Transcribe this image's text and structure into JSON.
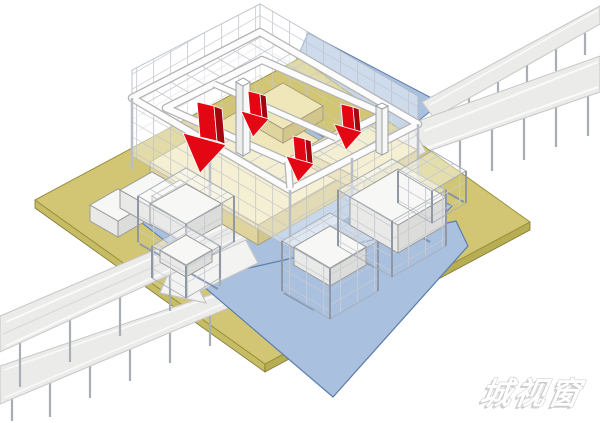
{
  "watermark": {
    "text": "城视窗"
  },
  "annotations": {
    "red_down_arrow_count": 4,
    "flow_arrow_direction": "southwest"
  },
  "colors": {
    "site_plate": "#d2c675",
    "site_plate_side": "#c6bc63",
    "canal_blue": "#a9c0de",
    "canal_blue_edge": "#5d7dab",
    "podium": "#efe6ba",
    "podium_side": "#e0d49e",
    "podium_side_dark": "#d2c68c",
    "road_fill": "#ebebea",
    "road_edge": "#c6c6c5",
    "red_arrow": "#e30713",
    "red_arrow_dark": "#a50510",
    "frame_line": "#a9b0ba",
    "white_volume": "#f7f7f5"
  }
}
